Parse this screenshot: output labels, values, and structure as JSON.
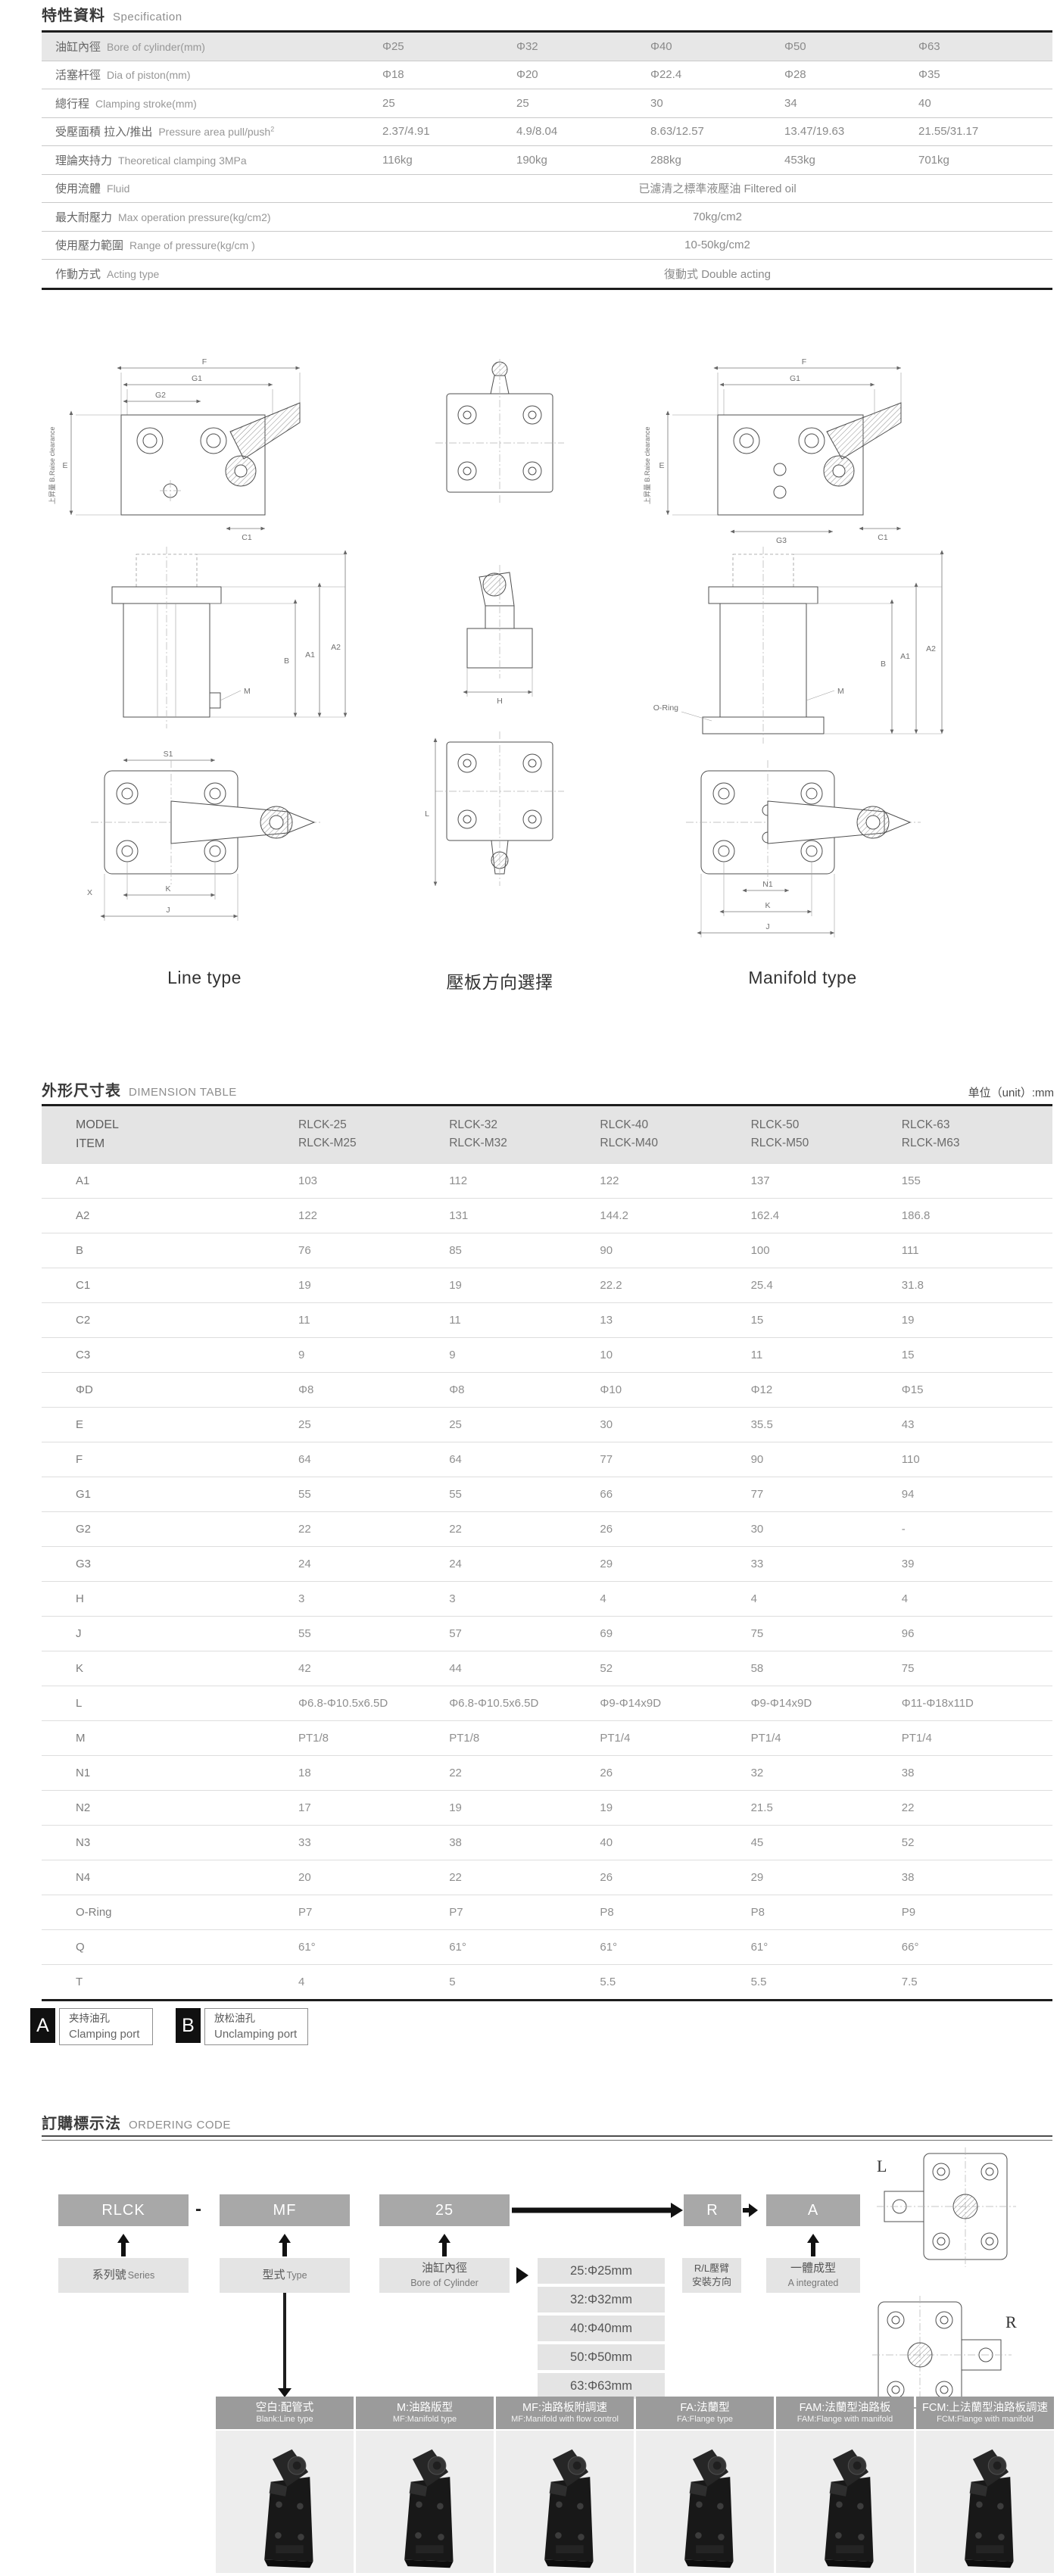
{
  "spec": {
    "title_zh": "特性資料",
    "title_en": "Specification",
    "table": {
      "rows": [
        {
          "header": true,
          "label_zh": "油缸內徑",
          "label_en": "Bore of cylinder(mm)",
          "values": [
            "Φ25",
            "Φ32",
            "Φ40",
            "Φ50",
            "Φ63"
          ]
        },
        {
          "label_zh": "活塞杆徑",
          "label_en": "Dia of piston(mm)",
          "values": [
            "Φ18",
            "Φ20",
            "Φ22.4",
            "Φ28",
            "Φ35"
          ]
        },
        {
          "label_zh": "總行程",
          "label_en": "Clamping stroke(mm)",
          "values": [
            "25",
            "25",
            "30",
            "34",
            "40"
          ]
        },
        {
          "label_zh": "受壓面積 拉入/推出",
          "label_en": "Pressure area pull/push",
          "sup": "2",
          "values": [
            "2.37/4.91",
            "4.9/8.04",
            "8.63/12.57",
            "13.47/19.63",
            "21.55/31.17"
          ]
        },
        {
          "label_zh": "理論夾持力",
          "label_en": "Theoretical clamping  3MPa",
          "values": [
            "116kg",
            "190kg",
            "288kg",
            "453kg",
            "701kg"
          ]
        },
        {
          "label_zh": "使用流體",
          "label_en": "Fluid",
          "span_value": "已濾清之標準液壓油 Filtered oil"
        },
        {
          "label_zh": "最大耐壓力",
          "label_en": "Max operation pressure(kg/cm2)",
          "span_value": "70kg/cm2"
        },
        {
          "label_zh": "使用壓力範圍",
          "label_en": "Range of pressure(kg/cm )",
          "span_value": "10-50kg/cm2"
        },
        {
          "label_zh": "作動方式",
          "label_en": "Acting type",
          "span_value": "復動式 Double acting"
        }
      ]
    }
  },
  "drawings": {
    "captions": [
      "Line type",
      "壓板方向選擇",
      "Manifold type"
    ],
    "left": {
      "raise_label": "上昇量 B.Raise clearance",
      "dims": [
        "F",
        "G1",
        "G2",
        "E",
        "C1",
        "M",
        "B",
        "A1",
        "A2",
        "S1",
        "K",
        "J",
        "X"
      ]
    },
    "mid": {
      "dims": [
        "H",
        "L"
      ]
    },
    "right": {
      "raise_label": "上昇量 B.Raise clearance",
      "oring_label": "O-Ring",
      "dims": [
        "F",
        "G1",
        "E",
        "G3",
        "C1",
        "M",
        "B",
        "A1",
        "A2",
        "N1",
        "K",
        "J"
      ]
    }
  },
  "dimension": {
    "title_zh": "外形尺寸表",
    "title_en": "DIMENSION TABLE",
    "unit_label": "单位（unit）:mm",
    "table": {
      "model_label": "MODEL",
      "item_label": "ITEM",
      "models": [
        [
          "RLCK-25",
          "RLCK-M25"
        ],
        [
          "RLCK-32",
          "RLCK-M32"
        ],
        [
          "RLCK-40",
          "RLCK-M40"
        ],
        [
          "RLCK-50",
          "RLCK-M50"
        ],
        [
          "RLCK-63",
          "RLCK-M63"
        ]
      ],
      "rows": [
        {
          "item": "A1",
          "values": [
            "103",
            "112",
            "122",
            "137",
            "155"
          ]
        },
        {
          "item": "A2",
          "values": [
            "122",
            "131",
            "144.2",
            "162.4",
            "186.8"
          ]
        },
        {
          "item": "B",
          "values": [
            "76",
            "85",
            "90",
            "100",
            "111"
          ]
        },
        {
          "item": "C1",
          "values": [
            "19",
            "19",
            "22.2",
            "25.4",
            "31.8"
          ]
        },
        {
          "item": "C2",
          "values": [
            "11",
            "11",
            "13",
            "15",
            "19"
          ]
        },
        {
          "item": "C3",
          "values": [
            "9",
            "9",
            "10",
            "11",
            "15"
          ]
        },
        {
          "item": "ΦD",
          "values": [
            "Φ8",
            "Φ8",
            "Φ10",
            "Φ12",
            "Φ15"
          ]
        },
        {
          "item": "E",
          "values": [
            "25",
            "25",
            "30",
            "35.5",
            "43"
          ]
        },
        {
          "item": "F",
          "values": [
            "64",
            "64",
            "77",
            "90",
            "110"
          ]
        },
        {
          "item": "G1",
          "values": [
            "55",
            "55",
            "66",
            "77",
            "94"
          ]
        },
        {
          "item": "G2",
          "values": [
            "22",
            "22",
            "26",
            "30",
            "-"
          ]
        },
        {
          "item": "G3",
          "values": [
            "24",
            "24",
            "29",
            "33",
            "39"
          ]
        },
        {
          "item": "H",
          "values": [
            "3",
            "3",
            "4",
            "4",
            "4"
          ]
        },
        {
          "item": "J",
          "values": [
            "55",
            "57",
            "69",
            "75",
            "96"
          ]
        },
        {
          "item": "K",
          "values": [
            "42",
            "44",
            "52",
            "58",
            "75"
          ]
        },
        {
          "item": "L",
          "values": [
            "Φ6.8-Φ10.5x6.5D",
            "Φ6.8-Φ10.5x6.5D",
            "Φ9-Φ14x9D",
            "Φ9-Φ14x9D",
            "Φ11-Φ18x11D"
          ]
        },
        {
          "item": "M",
          "values": [
            "PT1/8",
            "PT1/8",
            "PT1/4",
            "PT1/4",
            "PT1/4"
          ]
        },
        {
          "item": "N1",
          "values": [
            "18",
            "22",
            "26",
            "32",
            "38"
          ]
        },
        {
          "item": "N2",
          "values": [
            "17",
            "19",
            "19",
            "21.5",
            "22"
          ]
        },
        {
          "item": "N3",
          "values": [
            "33",
            "38",
            "40",
            "45",
            "52"
          ]
        },
        {
          "item": "N4",
          "values": [
            "20",
            "22",
            "26",
            "29",
            "38"
          ]
        },
        {
          "item": "O-Ring",
          "values": [
            "P7",
            "P7",
            "P8",
            "P8",
            "P9"
          ]
        },
        {
          "item": "Q",
          "values": [
            "61°",
            "61°",
            "61°",
            "61°",
            "66°"
          ]
        },
        {
          "item": "T",
          "values": [
            "4",
            "5",
            "5.5",
            "5.5",
            "7.5"
          ]
        }
      ]
    }
  },
  "ports": {
    "items": [
      {
        "code": "A",
        "zh": "夹持油孔",
        "en": "Clamping port"
      },
      {
        "code": "B",
        "zh": "放松油孔",
        "en": "Unclamping port"
      }
    ]
  },
  "ordering": {
    "title_zh": "訂購標示法",
    "title_en": "ORDERING CODE",
    "code_boxes": [
      "RLCK",
      "MF",
      "25",
      "R",
      "A"
    ],
    "separator": "-",
    "labels": {
      "series": {
        "zh": "系列號",
        "en": "Series"
      },
      "type": {
        "zh": "型式",
        "en": "Type"
      },
      "bore": {
        "zh": "油缸內徑",
        "en": "Bore of Cylinder"
      },
      "rl": {
        "line1": "R/L壓臂",
        "line2": "安裝方向"
      },
      "integrated": {
        "zh": "一體成型",
        "en": "A integrated"
      }
    },
    "bore_options": [
      "25:Φ25mm",
      "32:Φ32mm",
      "40:Φ40mm",
      "50:Φ50mm",
      "63:Φ63mm"
    ],
    "lr_labels": [
      "L",
      "R"
    ],
    "type_options": [
      {
        "zh": "空白:配管式",
        "en": "Blank:Line type"
      },
      {
        "zh": "M:油路版型",
        "en": "MF:Manifold type"
      },
      {
        "zh": "MF:油路板附調速",
        "en": "MF:Manifold with flow control"
      },
      {
        "zh": "FA:法蘭型",
        "en": "FA:Flange type"
      },
      {
        "zh": "FAM:法蘭型油路板",
        "en": "FAM:Flange with manifold"
      },
      {
        "zh": "FCM:上法蘭型油路板調速",
        "en": "FCM:Flange with manifold"
      }
    ]
  }
}
